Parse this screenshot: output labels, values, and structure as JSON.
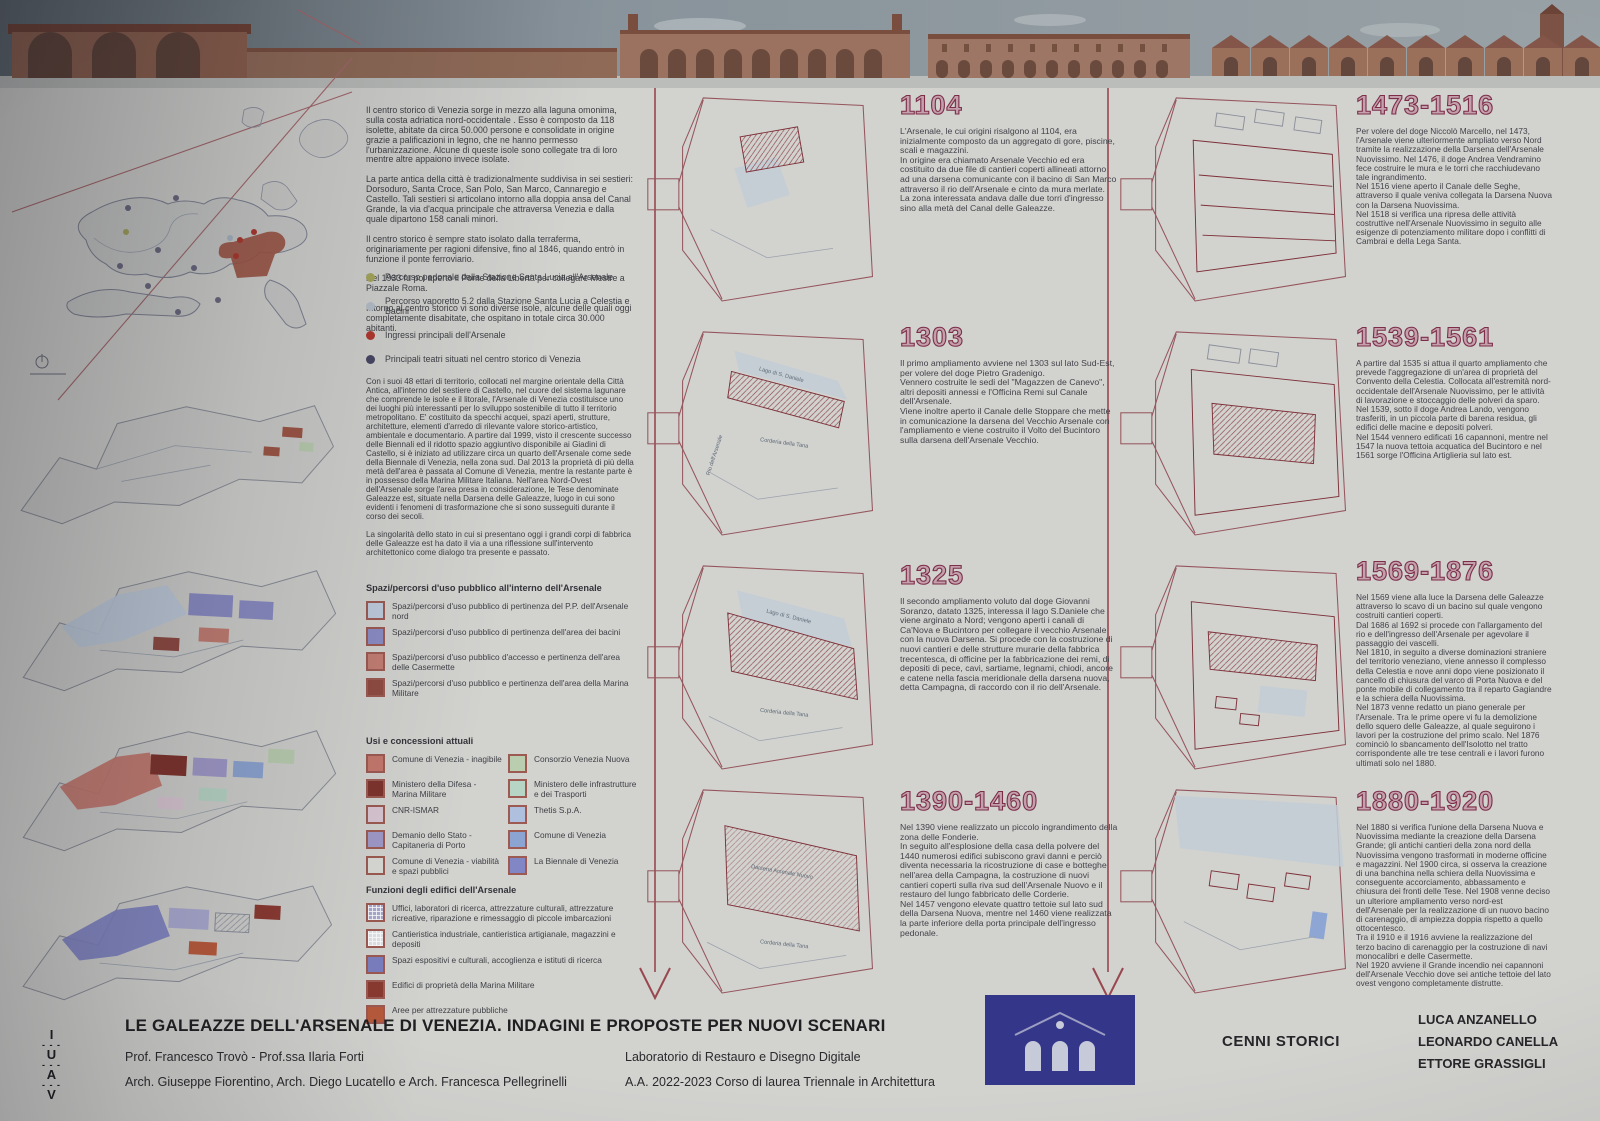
{
  "theme": {
    "year_color": "#7c2d49",
    "year_fill": "#c3a0ab",
    "timeline_color": "#99474e",
    "logo_bg": "#34368a"
  },
  "intro": {
    "p1": "Il centro storico di Venezia sorge in mezzo alla laguna omonima, sulla costa adriatica nord-occidentale . Esso è composto da 118 isolette, abitate da circa 50.000 persone e consolidate in origine grazie a palificazioni in legno, che ne hanno permesso l'urbanizzazione. Alcune di queste isole sono collegate tra di loro mentre altre appaiono invece isolate.",
    "p2": "La parte antica della città è tradizionalmente  suddivisa in sei sestieri: Dorsoduro, Santa Croce, San Polo, San Marco, Cannaregio e Castello. Tali sestieri si articolano intorno alla doppia ansa del Canal Grande, la via d'acqua principale che attraversa Venezia e dalla quale dipartono 158 canali minori.",
    "p3": "Il centro storico è sempre stato isolato dalla terraferma, originariamente per ragioni difensive, fino al 1846, quando entrò in funzione il ponte ferroviario.",
    "p4": "Nel 1933 fu poi aperto il Ponte della Libertà per collegare Mestre a Piazzale Roma.",
    "p5": "Intorno al centro storico vi sono diverse isole, alcune delle quali oggi completamente disabitate, che ospitano in totale circa 30.000 abitanti."
  },
  "routes": {
    "items": [
      {
        "color": "#a6a75c",
        "label": "Percorso pedonale dalla Stazione Santa Lucia all'Arsenale"
      },
      {
        "color": "#b6c0c9",
        "label": "Percorso vaporetto 5.2 dalla Stazione Santa Lucia a Celestia e Bacini"
      },
      {
        "color": "#b2392e",
        "label": "Ingressi principali dell'Arsenale"
      },
      {
        "color": "#474764",
        "label": "Principali teatri situati nel centro storico di Venezia"
      }
    ]
  },
  "arsenale": {
    "p1": "Con i suoi 48 ettari di territorio, collocati nel margine orientale della Città Antica, all'interno del sestiere di Castello, nel cuore del sistema lagunare che comprende le isole e il litorale, l'Arsenale di Venezia costituisce uno dei luoghi più interessanti per lo sviluppo sostenibile di tutto il territorio metropolitano. E' costituito da specchi acquei, spazi aperti, strutture, architetture, elementi d'arredo di rilevante valore storico-artistico, ambientale e documentario. A partire dal 1999, visto il crescente successo delle Biennali ed il ridotto spazio aggiuntivo disponibile ai Giadini di Castello, si è iniziato ad utilizzare circa un quarto dell'Arsenale come sede della Biennale di Venezia, nella zona sud. Dal 2013 la proprietà di più della metà dell'area è passata al Comune di Venezia, mentre la restante parte è in possesso della Marina Militare Italiana. Nell'area Nord-Ovest dell'Arsenale sorge l'area presa in considerazione, le Tese denominate Galeazze est, situate nella Darsena delle Galeazze, luogo in cui sono evidenti i fenomeni di trasformazione che si sono susseguiti durante il corso dei secoli.",
    "p2": "La singolarità dello stato in cui si presentano oggi i grandi corpi di fabbrica delle Galeazze est ha dato il via a una riflessione sull'intervento architettonico come dialogo tra presente e passato."
  },
  "legend_spazi": {
    "title": "Spazi/percorsi d'uso pubblico all'interno dell'Arsenale",
    "items": [
      {
        "color": "#becbdc",
        "label": "Spazi/percorsi d'uso pubblico di pertinenza del P.P. dell'Arsenale nord"
      },
      {
        "color": "#8a8cc4",
        "label": "Spazi/percorsi d'uso pubblico di pertinenza dell'area dei bacini"
      },
      {
        "color": "#c27d72",
        "label": "Spazi/percorsi d'uso pubblico d'accesso e  pertinenza dell'area delle Casermette"
      },
      {
        "color": "#8f4a42",
        "label": "Spazi/percorsi d'uso pubblico e pertinenza dell'area della Marina Militare"
      }
    ]
  },
  "legend_usi": {
    "title": "Usi e concessioni attuali",
    "items": [
      {
        "color": "#c4776c",
        "label": "Comune di Venezia - inagibile"
      },
      {
        "color": "#7e332d",
        "label": "Ministero della Difesa - Marina Militare"
      },
      {
        "color": "#d8c6d2",
        "label": "CNR-ISMAR"
      },
      {
        "color": "#9f99c8",
        "label": "Demanio dello Stato - Capitaneria di Porto"
      },
      {
        "color": "#d9d9d5",
        "label": "Comune di Venezia - viabilità e spazi pubblici"
      },
      {
        "color": "#b9cdaf",
        "label": "Consorzio Venezia Nuova"
      },
      {
        "color": "#b7d5c5",
        "label": "Ministero delle infrastrutture e dei Trasporti"
      },
      {
        "color": "#afc0de",
        "label": "Thetis S.p.A."
      },
      {
        "color": "#8ca4d1",
        "label": "Comune di Venezia"
      },
      {
        "color": "#8087c4",
        "label": "La Biennale di Venezia"
      }
    ]
  },
  "legend_funzioni": {
    "title": "Funzioni degli edifici dell'Arsenale",
    "items": [
      {
        "color": "#a9a9d0",
        "label": "Uffici, laboratori di ricerca, attrezzature culturali, attrezzature ricreative, riparazione e rimessaggio di piccole imbarcazioni"
      },
      {
        "color": "#dfe3e6",
        "label": "Cantieristica industriale, cantieristica artigianale, magazzini e depositi"
      },
      {
        "color": "#7b7fc0",
        "label": "Spazi espositivi e culturali, accoglienza e istituti di ricerca"
      },
      {
        "color": "#8a3a31",
        "label": "Edifici di proprietà della Marina Militare"
      },
      {
        "color": "#b85a3c",
        "label": "Aree per attrezzature pubbliche"
      }
    ]
  },
  "timeline": [
    {
      "year": "1104",
      "text": "L'Arsenale, le cui origini risalgono al 1104, era inizialmente composto da un aggregato di gore, piscine, scali e magazzini.\nIn origine era chiamato Arsenale Vecchio ed era costituito da due file di cantieri coperti allineati attorno ad una darsena comunicante con il bacino di San Marco attraverso il rio dell'Arsenale e cinto da mura merlate.\nLa zona interessata andava dalle due torri d'ingresso sino alla metà del Canal delle Galeazze."
    },
    {
      "year": "1303",
      "text": "Il primo ampliamento avviene nel 1303 sul lato Sud-Est, per volere del doge Pietro Gradenigo.\nVennero costruite le sedi del \"Magazzen de Canevo\", altri depositi annessi e l'Officina Remi sul Canale dell'Arsenale.\nViene inoltre aperto il Canale delle Stoppare che mette in comunicazione la darsena del Vecchio Arsenale con l'ampliamento e viene costruito il Volto del Bucintoro sulla darsena dell'Arsenale Vecchio."
    },
    {
      "year": "1325",
      "text": "Il secondo ampliamento voluto dal doge Giovanni Soranzo, datato 1325, interessa il lago S.Daniele che viene arginato a Nord; vengono aperti i canali di Ca'Nova e Bucintoro per collegare il vecchio Arsenale con la nuova Darsena. Si procede con la costruzione di nuovi cantieri e delle strutture murarie della fabbrica trecentesca, di officine per la fabbricazione dei remi, di depositi di pece, cavi, sartiame, legnami, chiodi, ancore e catene nella fascia meridionale della darsena nuova, detta Campagna, di raccordo con il rio dell'Arsenale."
    },
    {
      "year": "1390-1460",
      "text": "Nel 1390 viene realizzato un piccolo ingrandimento della zona delle Fonderie.\nIn seguito all'esplosione della casa della polvere del 1440 numerosi edifici subiscono gravi danni e perciò diventa necessaria la ricostruzione di case e botteghe nell'area della Campagna, la costruzione di nuovi cantieri coperti sulla riva sud dell'Arsenale Nuovo e il restauro del lungo fabbricato delle Corderie.\nNel 1457 vengono elevate quattro tettoie sul lato sud della Darsena Nuova, mentre nel 1460 viene realizzata la parte inferiore della porta principale dell'ingresso pedonale."
    },
    {
      "year": "1473-1516",
      "text": "Per volere del doge Niccolò Marcello, nel 1473, l'Arsenale viene ulteriormente ampliato verso Nord tramite la realizzazione della Darsena dell'Arsenale Nuovissimo. Nel 1476, il doge Andrea Vendramino fece costruire le mura e le torri che racchiudevano tale ingrandimento.\nNel 1516 viene aperto il Canale delle Seghe, attraverso il quale veniva collegata la Darsena Nuova con la Darsena Nuovissima.\nNel 1518 si verifica una ripresa delle attività costruttive nell'Arsenale Nuovissimo in seguito alle esigenze di potenziamento militare dopo i conflitti di Cambrai e della Lega Santa."
    },
    {
      "year": "1539-1561",
      "text": "A partire dal 1535 si attua il quarto ampliamento che prevede l'aggregazione di un'area di proprietà del Convento della Celestia. Collocata all'estremità nord-occidentale dell'Arsenale Nuovissimo, per le attività di lavorazione e stoccaggio delle polveri da sparo.\nNel 1539, sotto il doge Andrea Lando, vengono trasferiti, in un piccola parte di barena residua, gli edifici delle macine e depositi polveri.\nNel 1544 vennero edificati 16 capannoni, mentre nel 1547 la nuova tettoia acquatica del Bucintoro e nel 1561 sorge l'Officina Artiglieria sul lato est."
    },
    {
      "year": "1569-1876",
      "text": "Nel 1569 viene alla luce la Darsena delle Galeazze attraverso lo scavo di un bacino sul quale vengono costruiti cantieri coperti.\nDal 1686 al 1692 si procede con l'allargamento del rio e dell'ingresso dell'Arsenale per agevolare il passaggio dei vascelli.\nNel 1810, in seguito a diverse dominazioni straniere del territorio veneziano, viene annesso il complesso della Celestia e nove anni dopo viene posizionato il cancello di chiusura del varco di Porta Nuova e del ponte mobile di collegamento tra il reparto Gagiandre e la schiera della Nuovissima.\nNel 1873 venne redatto un piano generale per l'Arsenale. Tra le prime opere vi fu la demolizione dello squero delle Galeazze, al quale seguirono i lavori per la costruzione del primo scalo. Nel 1876 cominciò lo sbancamento dell'Isolotto nel tratto corrispondente alle tre tese centrali e i lavori furono ultimati solo nel 1880."
    },
    {
      "year": "1880-1920",
      "text": "Nel 1880 si verifica l'unione della Darsena Nuova e Nuovissima mediante la creazione della Darsena Grande; gli antichi cantieri della zona nord della Nuovissima vengono trasformati in moderne officine e magazzini. Nel 1900 circa, si osserva la creazione di una banchina nella schiera della Nuovissima e conseguente accorciamento, abbassamento e chiusura dei fronti delle Tese. Nel 1908 venne deciso un ulteriore ampliamento verso nord-est dell'Arsenale per la realizzazione di un nuovo bacino di carenaggio, di ampiezza doppia rispetto a quello ottocentesco.\nTra il 1910 e il 1916 avviene la realizzazione del terzo bacino di carenaggio per la costruzione di navi monocalibri e delle Casermette.\nNel 1920 avviene il Grande incendio nei capannoni dell'Arsenale Vecchio dove sei antiche tettoie del lato ovest vengono completamente distrutte."
    }
  ],
  "plan_labels": {
    "lago": "Lago di S. Daniele",
    "corderia": "Corderia della Tana",
    "rio": "Rio dell'Arsenale",
    "darsena_nuovo": "Darsena Arsenale Nuovo"
  },
  "footer": {
    "title": "LE GALEAZZE DELL'ARSENALE DI VENEZIA. INDAGINI E PROPOSTE PER NUOVI SCENARI",
    "line1": "Prof. Francesco Trovò - Prof.ssa Ilaria Forti",
    "line2": "Arch. Giuseppe Fiorentino, Arch. Diego Lucatello e Arch. Francesca Pellegrinelli",
    "lab1": "Laboratorio di Restauro e Disegno Digitale",
    "lab2": "A.A. 2022-2023 Corso di laurea Triennale in Architettura",
    "section": "CENNI STORICI",
    "authors": [
      "LUCA ANZANELLO",
      "LEONARDO CANELLA",
      "ETTORE GRASSIGLI"
    ],
    "logo_letters": [
      "I",
      "U",
      "A",
      "V"
    ],
    "logo_dash": "- - -"
  }
}
